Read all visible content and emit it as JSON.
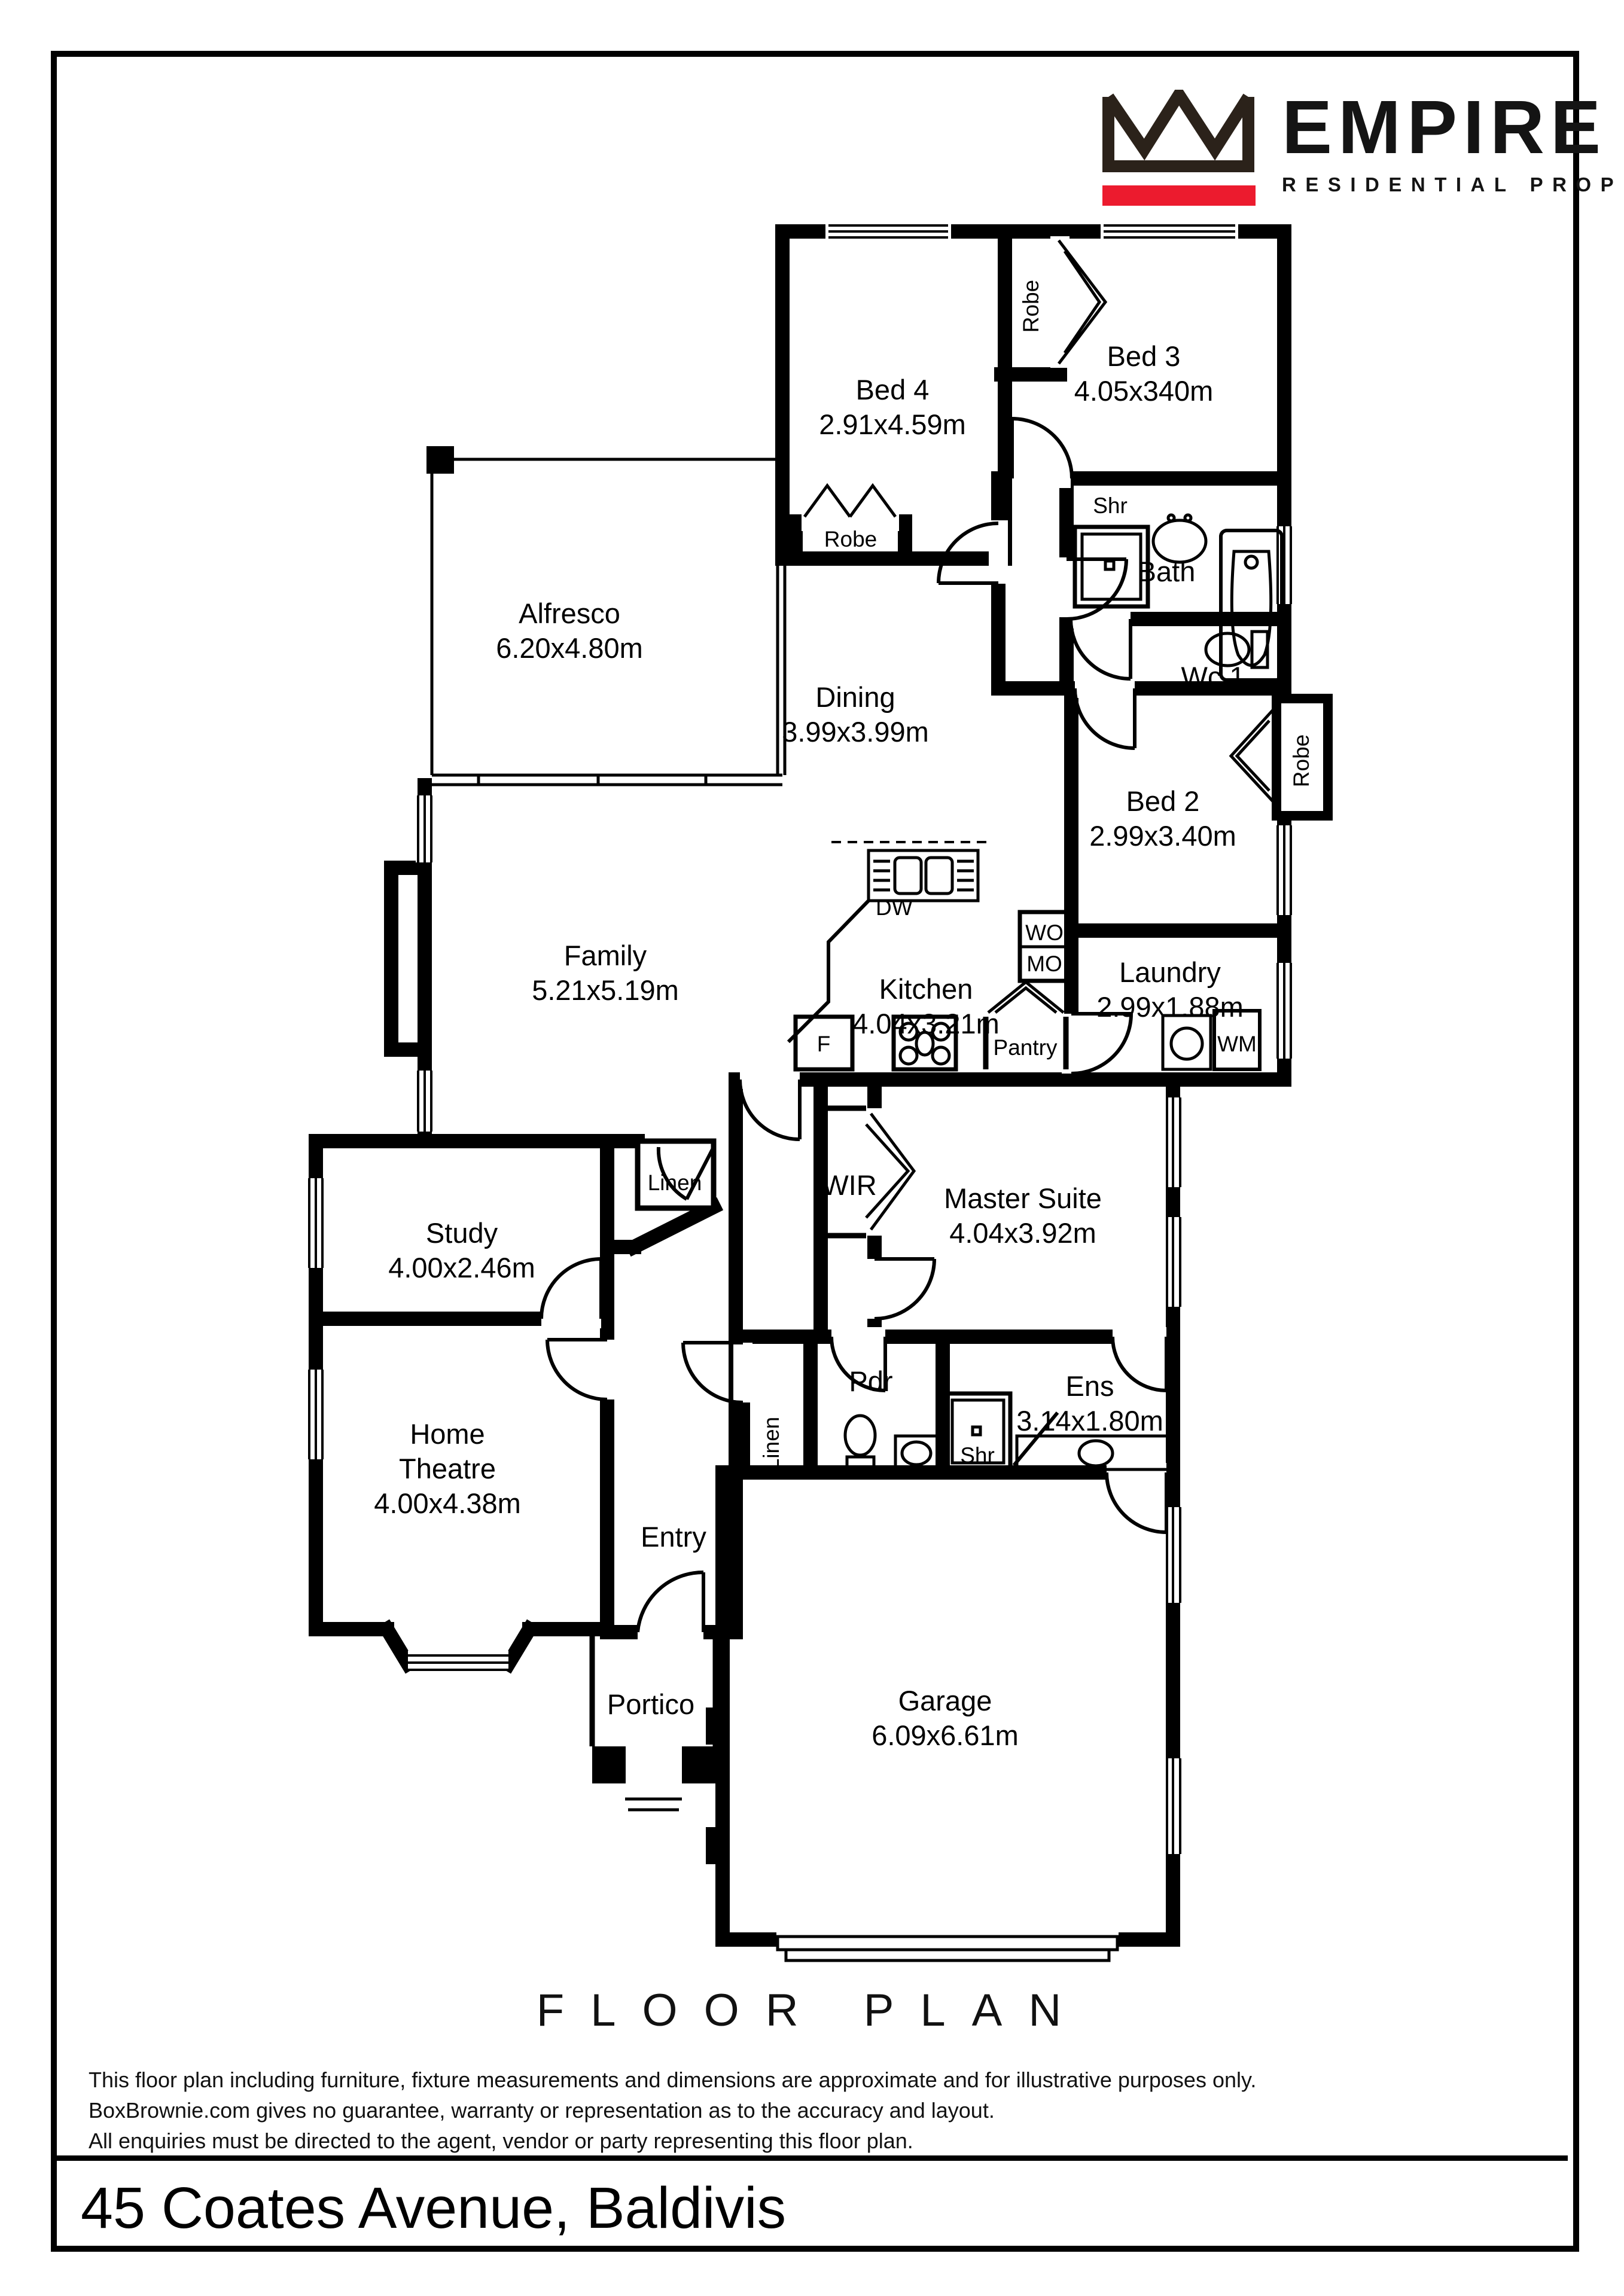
{
  "logo": {
    "brand": "EMPIRE",
    "tagline": "RESIDENTIAL PROPERTY",
    "crown_color": "#2b221a",
    "accent_color": "#ec1b2e"
  },
  "title": "FLOOR PLAN",
  "address": "45 Coates Avenue, Baldivis",
  "disclaimer": {
    "line1": "This floor plan including furniture, fixture measurements and dimensions are approximate and for illustrative purposes only.",
    "line2": "BoxBrownie.com gives no guarantee, warranty or representation as to the accuracy and layout.",
    "line3": "All enquiries must be directed to the agent, vendor or party representing this floor plan."
  },
  "rooms": {
    "bed4": {
      "name": "Bed 4",
      "dims": "2.91x4.59m"
    },
    "bed3": {
      "name": "Bed 3",
      "dims": "4.05x340m"
    },
    "bed2": {
      "name": "Bed 2",
      "dims": "2.99x3.40m"
    },
    "alfresco": {
      "name": "Alfresco",
      "dims": "6.20x4.80m"
    },
    "dining": {
      "name": "Dining",
      "dims": "3.99x3.99m"
    },
    "family": {
      "name": "Family",
      "dims": "5.21x5.19m"
    },
    "kitchen": {
      "name": "Kitchen",
      "dims": "4.04x3.21m"
    },
    "laundry": {
      "name": "Laundry",
      "dims": "2.99x1.88m"
    },
    "bath": {
      "name": "Bath"
    },
    "wc1": {
      "name": "Wc 1"
    },
    "study": {
      "name": "Study",
      "dims": "4.00x2.46m"
    },
    "master": {
      "name": "Master Suite",
      "dims": "4.04x3.92m"
    },
    "home_theatre": {
      "line1": "Home",
      "line2": "Theatre",
      "dims": "4.00x4.38m"
    },
    "ens": {
      "name": "Ens",
      "dims": "3.14x1.80m"
    },
    "pdr": {
      "name": "Pdr"
    },
    "entry": {
      "name": "Entry"
    },
    "portico": {
      "name": "Portico"
    },
    "garage": {
      "name": "Garage",
      "dims": "6.09x6.61m"
    }
  },
  "fixtures": {
    "robe": "Robe",
    "shr": "Shr",
    "linen": "Linen",
    "wir": "WIR",
    "dw": "DW",
    "wo": "WO",
    "mo": "MO",
    "fridge": "F",
    "pantry": "Pantry",
    "wm": "WM"
  }
}
